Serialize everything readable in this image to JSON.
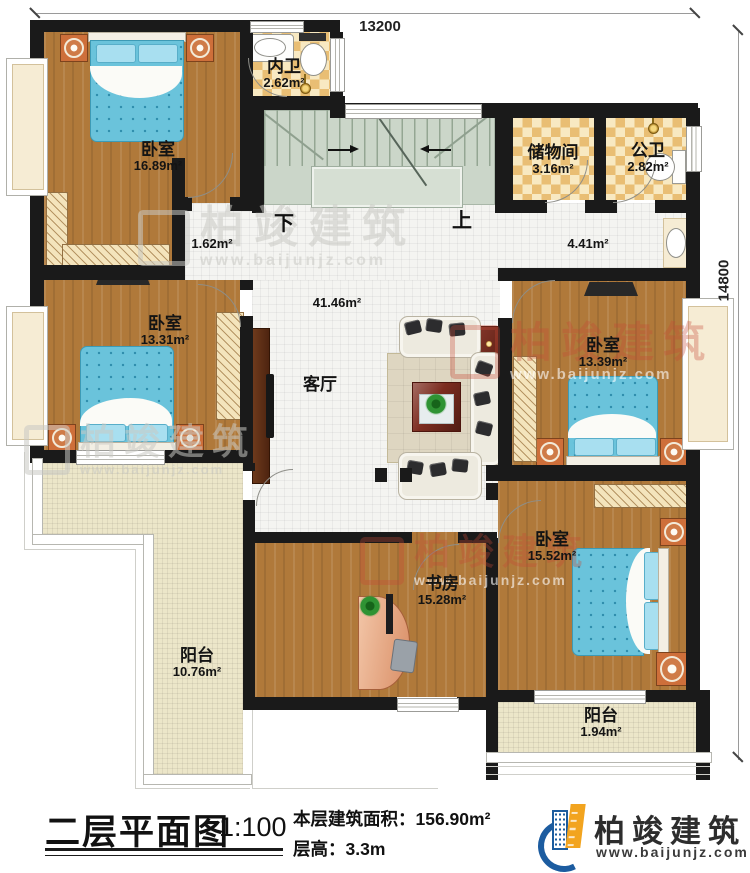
{
  "dimensions": {
    "top": "13200",
    "right": "14800"
  },
  "rooms": {
    "bedroom_tl": {
      "name": "卧室",
      "area": "16.89m²"
    },
    "inner_bath": {
      "name": "内卫",
      "area": "2.62m²"
    },
    "storage": {
      "name": "储物间",
      "area": "3.16m²"
    },
    "public_bath": {
      "name": "公卫",
      "area": "2.82m²"
    },
    "hall_small": {
      "area": "1.62m²"
    },
    "hall": {
      "area": "4.41m²"
    },
    "living": {
      "name": "客厅",
      "area": "41.46m²"
    },
    "bedroom_ml": {
      "name": "卧室",
      "area": "13.31m²"
    },
    "bedroom_r": {
      "name": "卧室",
      "area": "13.39m²"
    },
    "bedroom_br": {
      "name": "卧室",
      "area": "15.52m²"
    },
    "study": {
      "name": "书房",
      "area": "15.28m²"
    },
    "balcony_l": {
      "name": "阳台",
      "area": "10.76m²"
    },
    "balcony_r": {
      "name": "阳台",
      "area": "1.94m²"
    }
  },
  "stairs": {
    "down": "下",
    "up": "上"
  },
  "footer": {
    "plan_title": "二层平面图",
    "scale": "1:100",
    "area_label": "本层建筑面积：",
    "area_value": "156.90m²",
    "height_label": "层高：",
    "height_value": "3.3m"
  },
  "brand": {
    "name": "柏竣建筑",
    "url": "www.baijunjz.com"
  },
  "colors": {
    "wall": "#1a1a1a",
    "wood": "#b0793a",
    "bath_tile": "#e9be74",
    "stair": "#cbd6c9",
    "bed": "#6ac3db",
    "balcony_tile": "#ebe5c8",
    "brand_blue": "#1b5c9e",
    "brand_orange": "#f2a41f",
    "watermark_red": "#c64838"
  }
}
